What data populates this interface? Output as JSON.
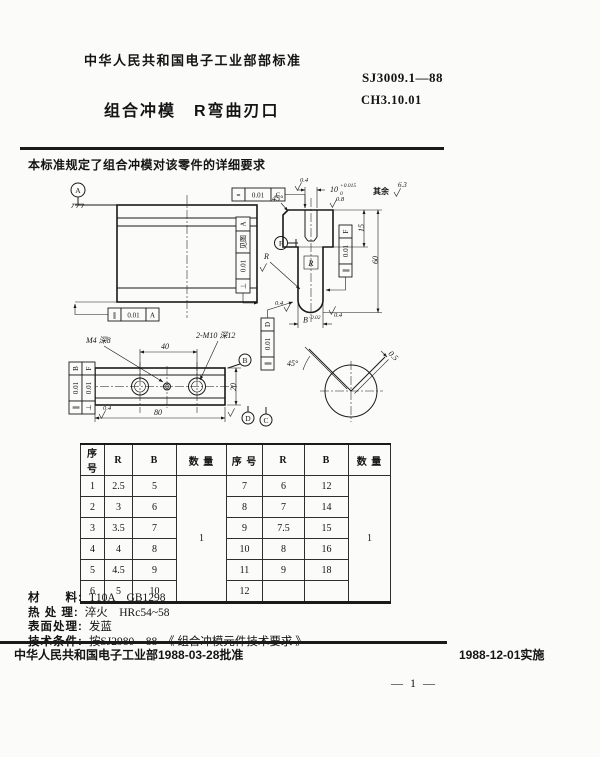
{
  "header": {
    "org": "中华人民共和国电子工业部部标准",
    "standard_no": "SJ3009.1—88",
    "title": "组合冲模　R弯曲刃口",
    "code": "CH3.10.01"
  },
  "intro": {
    "text": "本标准规定了组合冲模对该零件的详细要求"
  },
  "drawing": {
    "datums": {
      "a": "A",
      "b": "B",
      "c": "C",
      "d": "D",
      "f": "F"
    },
    "fcf": {
      "sym_c": {
        "sym": "=",
        "tol": "0.01",
        "datum": "C"
      },
      "perp_a": {
        "sym": "⊥",
        "tol": "0.01",
        "datum": "A",
        "note": "见图"
      },
      "par_a": {
        "sym": "∥",
        "tol": "0.01",
        "datum": "A"
      },
      "par_f": {
        "sym": "∥",
        "tol": "0.01",
        "datum": "F"
      },
      "par_d": {
        "sym": "∥",
        "tol": "0.01",
        "datum": "D"
      },
      "par_b": {
        "sym": "∥",
        "tol": "0.01",
        "datum": "B"
      },
      "perp_f": {
        "sym": "⊥",
        "tol": "0.01",
        "datum": "F"
      }
    },
    "dims": {
      "hole_nominal": "10",
      "hole_upper": "+0.015",
      "hole_lower": "0",
      "height_60": "60",
      "depth_15": "15",
      "width_b": "B",
      "width_b_tol": "-0.02",
      "pitch_40": "40",
      "length_80": "80",
      "width_20": "20",
      "gap_05": "0.5"
    },
    "labels": {
      "chamfer_angle": "45°",
      "detail_angle": "45°",
      "thread_m4": "M4 深8",
      "thread_m10": "2-M10 深12",
      "r_box": "R",
      "r_leader": "R",
      "rest_label": "其余",
      "rest_value": "6.3",
      "finish_04": "0.4",
      "finish_08": "0.8"
    }
  },
  "table": {
    "headers": [
      "序 号",
      "R",
      "B",
      "数 量",
      "序 号",
      "R",
      "B",
      "数 量"
    ],
    "left_rows": [
      [
        "1",
        "2.5",
        "5"
      ],
      [
        "2",
        "3",
        "6"
      ],
      [
        "3",
        "3.5",
        "7"
      ],
      [
        "4",
        "4",
        "8"
      ],
      [
        "5",
        "4.5",
        "9"
      ],
      [
        "6",
        "5",
        "10"
      ]
    ],
    "left_qty": "1",
    "right_rows": [
      [
        "7",
        "6",
        "12"
      ],
      [
        "8",
        "7",
        "14"
      ],
      [
        "9",
        "7.5",
        "15"
      ],
      [
        "10",
        "8",
        "16"
      ],
      [
        "11",
        "9",
        "18"
      ],
      [
        "12",
        "",
        ""
      ]
    ],
    "right_qty": "1"
  },
  "specs": {
    "material_label": "材　　料:",
    "material_value": "T10A　GB1298",
    "heat_label": "热 处 理:",
    "heat_value": "淬火　HRc54~58",
    "surface_label": "表面处理:",
    "surface_value": "发蓝",
    "tech_label": "技术条件:",
    "tech_value": "按SJ2980—88　《 组合冲模元件技术要求 》"
  },
  "footer": {
    "approval": "中华人民共和国电子工业部1988-03-28批准",
    "implementation": "1988-12-01实施",
    "page_no": "— 1 —"
  }
}
